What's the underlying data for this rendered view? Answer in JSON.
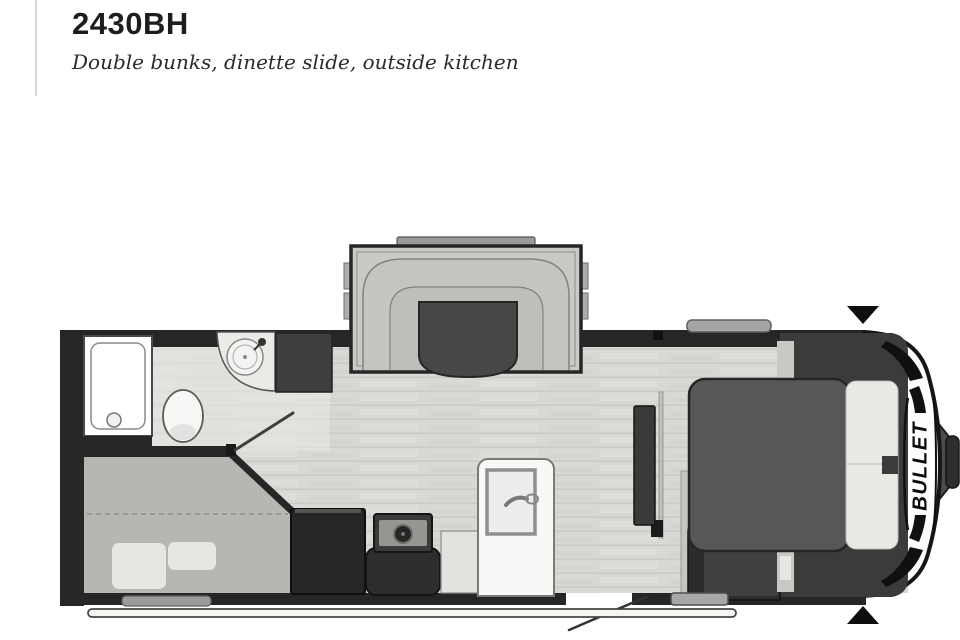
{
  "page": {
    "title": "2430BH",
    "subtitle": "Double bunks, dinette slide, outside kitchen"
  },
  "floorplan": {
    "brand_label": "BULLET",
    "fixtures": [
      "shower",
      "toilet",
      "corner-sink",
      "wardrobe",
      "dinette-slide",
      "dinette-table",
      "refrigerator",
      "range",
      "entry-door",
      "double-bunks",
      "queen-bed",
      "tv",
      "entry-step",
      "awning-rail",
      "a-frame-hitch"
    ],
    "colors": {
      "wall": "#262626",
      "floor": "#d9d8d4",
      "bunk_area": "#b8b6b3",
      "bedroom_dark": "#3b3b3b",
      "mattress": "#575757",
      "pillow": "#eae9e5",
      "cap_white": "#fdfdfd",
      "accent_black": "#0e0e0e",
      "slide_body": "#cbc9c5"
    }
  }
}
